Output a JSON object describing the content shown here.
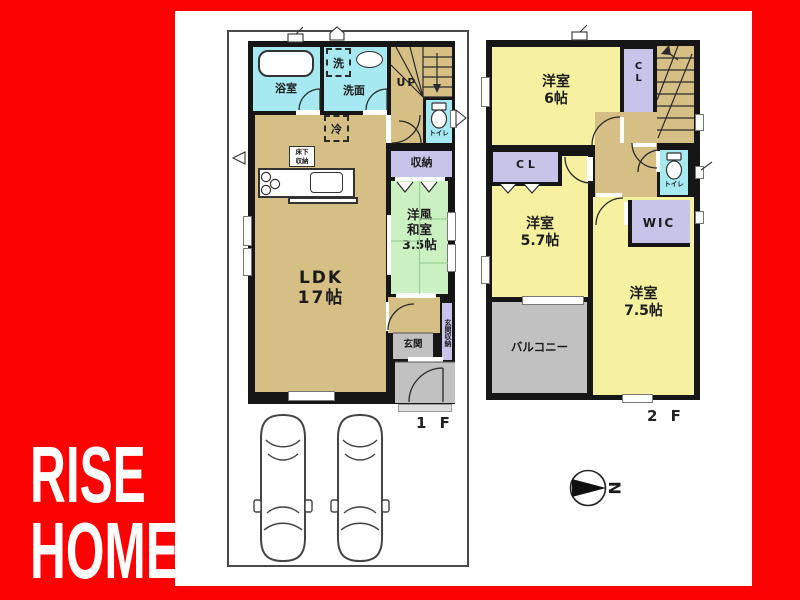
{
  "brand": {
    "line1": "RISE",
    "line2": "HOME"
  },
  "floor1": {
    "floor_label": "1 F",
    "bath": "浴室",
    "washer": "洗",
    "washroom": "洗面",
    "stairs_up": "UP",
    "toilet": "トイレ",
    "fridge": "冷",
    "underfloor_storage": "床下\n収納",
    "storage": "収納",
    "tatami_room": "洋風\n和室\n3.5帖",
    "ldk": "LDK\n17帖",
    "entrance": "玄関",
    "entrance_storage": "玄関収納"
  },
  "floor2": {
    "floor_label": "2 F",
    "bedroom6": "洋室\n6帖",
    "closet_top": "C\nL",
    "closet_mid": "C L",
    "bedroom57": "洋室\n5.7帖",
    "wic": "WIC",
    "toilet": "トイレ",
    "bedroom75": "洋室\n7.5帖",
    "balcony": "バルコニー"
  },
  "compass": {
    "north": "N"
  },
  "colors": {
    "background_red": "#FC0303",
    "wall_black": "#161616",
    "floor_tan": "#D5BF85",
    "room_yellow": "#F5F1A0",
    "tatami_green": "#CBF0C2",
    "wet_cyan": "#A6E9F1",
    "closet_lavender": "#C8C4E9",
    "balcony_gray": "#C1C1C1"
  }
}
